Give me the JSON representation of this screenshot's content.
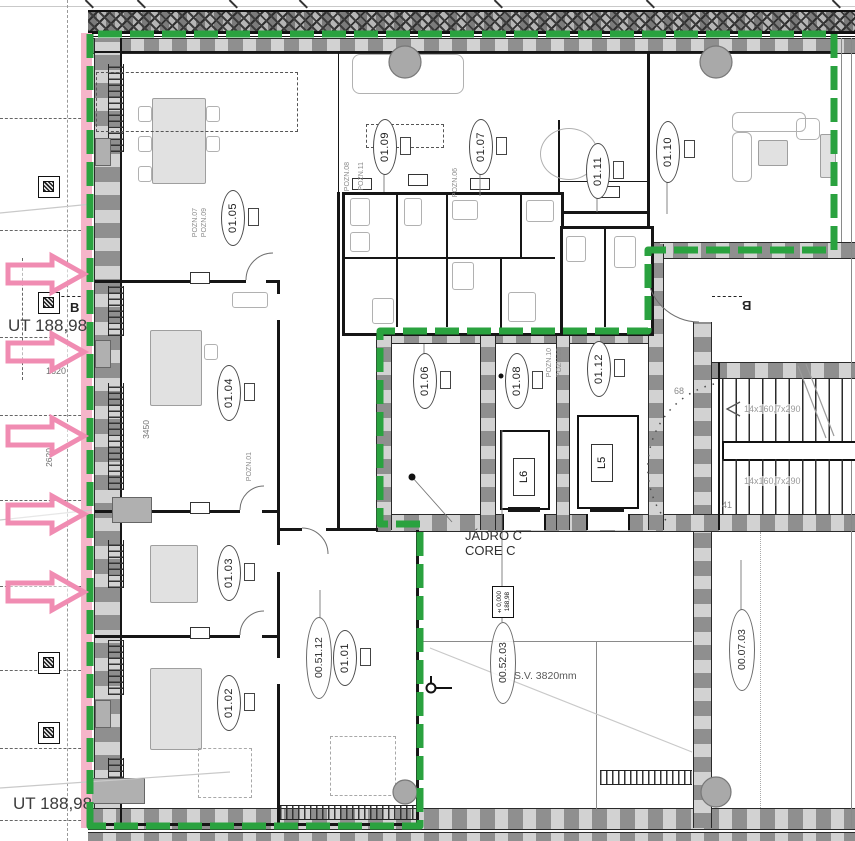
{
  "document": {
    "type": "architectural-floor-plan"
  },
  "levels": {
    "upper": "UT 188,98",
    "lower": "UT 188,98"
  },
  "core": {
    "name_local": "JÁDRO C",
    "name_en": "CORE C"
  },
  "elevators": [
    {
      "id": "L6"
    },
    {
      "id": "L5"
    }
  ],
  "rooms": [
    {
      "id": "01.01"
    },
    {
      "id": "01.02"
    },
    {
      "id": "01.03"
    },
    {
      "id": "01.04"
    },
    {
      "id": "01.05"
    },
    {
      "id": "01.06"
    },
    {
      "id": "01.07"
    },
    {
      "id": "01.08"
    },
    {
      "id": "01.09"
    },
    {
      "id": "01.10"
    },
    {
      "id": "01.11"
    },
    {
      "id": "01.12"
    }
  ],
  "zones": [
    {
      "id": "00.51.12"
    },
    {
      "id": "00.52.03"
    },
    {
      "id": "00.07.03"
    }
  ],
  "stairs": {
    "run_upper": "14x160,7x290",
    "run_lower": "14x160,7x290",
    "step_top": "68",
    "step_bottom": "41"
  },
  "level_mark": {
    "line1": "±0,000",
    "line2": "188,98"
  },
  "ceiling": {
    "sv": "S.V. 3820mm"
  },
  "section_marks": {
    "left": "B",
    "right": "B"
  },
  "dimensions": {
    "d1": "1620",
    "d2": "2620",
    "d3": "3450"
  },
  "notes": {
    "n1": "POZN.07",
    "n2": "POZN.09",
    "n3": "POZN.08",
    "n4": "POZN.11",
    "n5": "POZN.06",
    "n6": "POZN.10",
    "n7": "POZN.13",
    "n8": "POZN.01"
  },
  "colors": {
    "boundary_green": "#2aa23f",
    "highlight_pink": "#f08cb2",
    "pink_band": "#f5b5c9",
    "wall_fill": "#d2d2d2",
    "wall_dash": "#8f8f8f"
  }
}
